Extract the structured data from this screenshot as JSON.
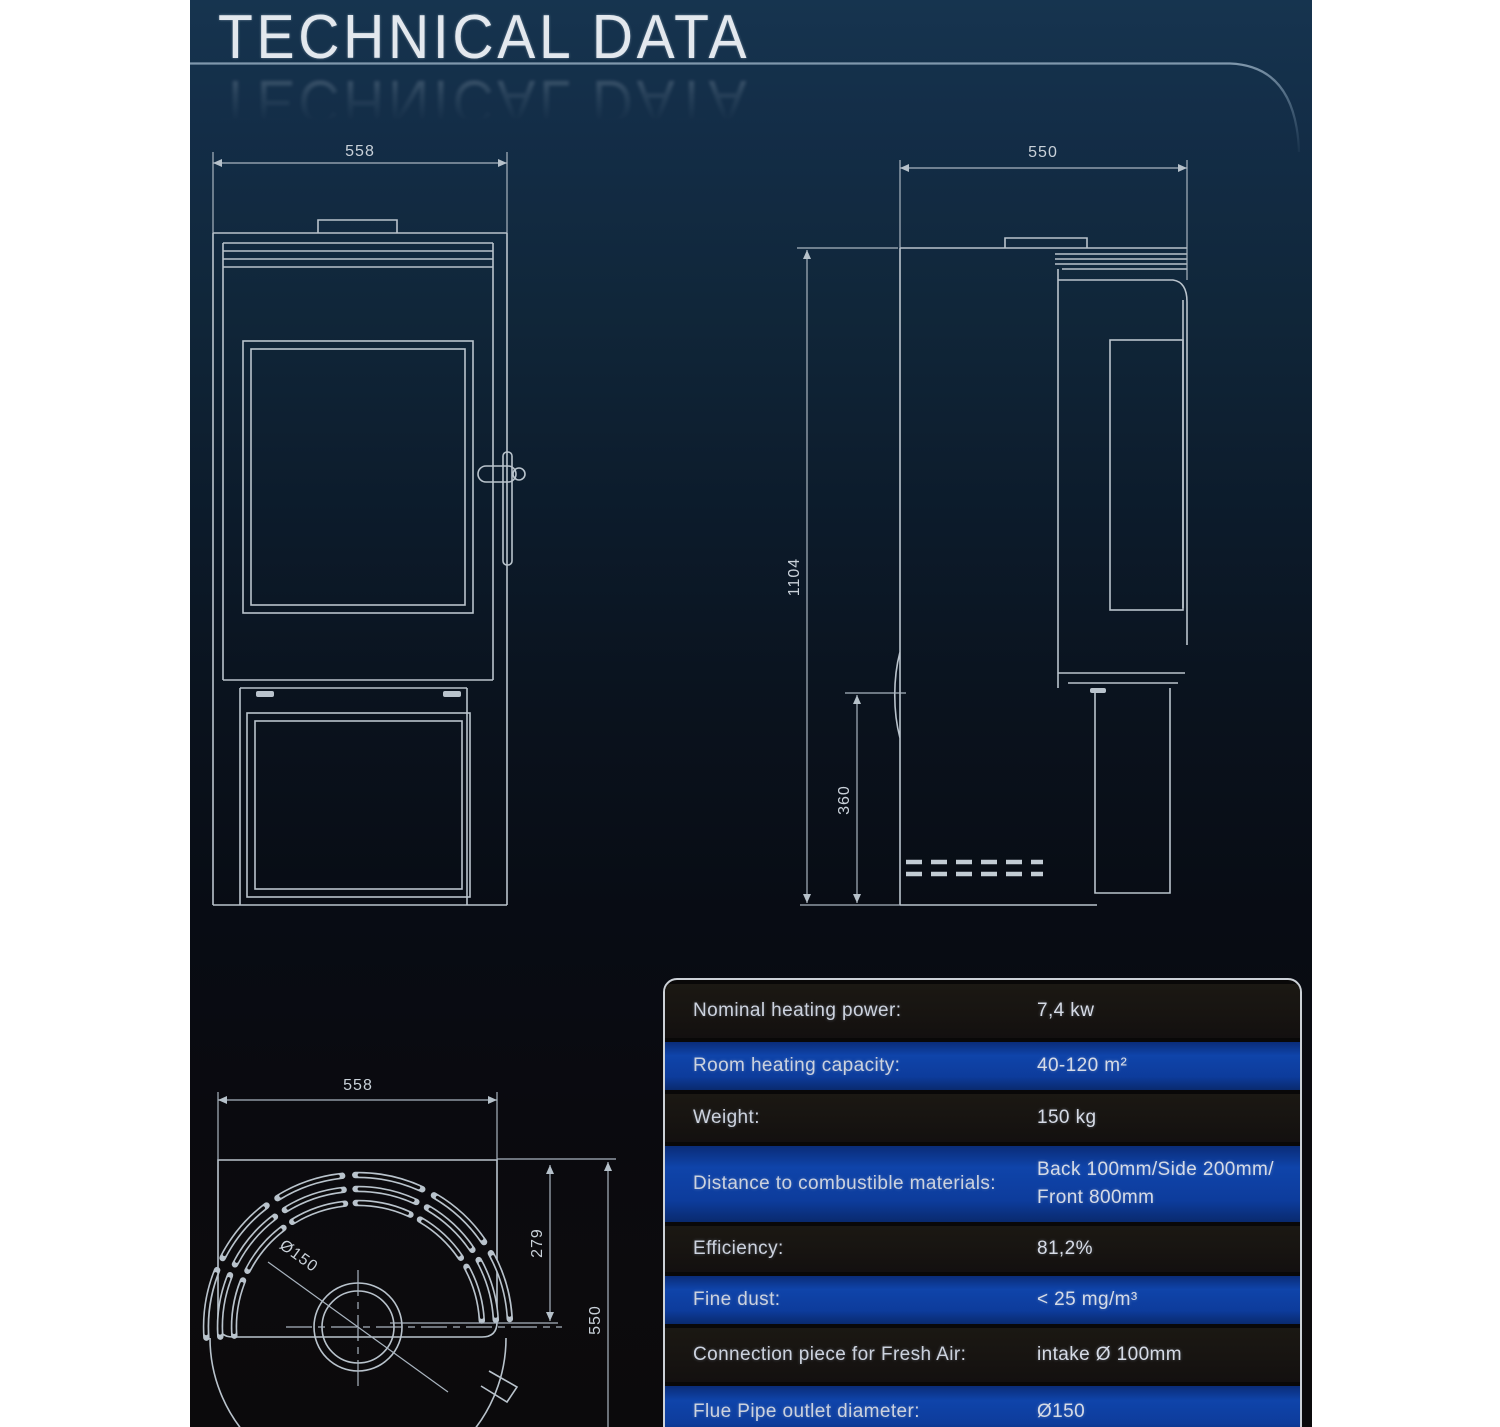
{
  "title": "TECHNICAL DATA",
  "drawings": {
    "front": {
      "width": "558"
    },
    "side": {
      "depth": "550",
      "height": "1104",
      "inlet_height": "360"
    },
    "top": {
      "width": "558",
      "flue_offset": "279",
      "depth": "550",
      "flue_diameter": "Ø150"
    }
  },
  "table": {
    "rows": [
      {
        "label": "Nominal heating power:",
        "value": "7,4 kw",
        "variant": "dark"
      },
      {
        "label": "Room heating capacity:",
        "value": "40-120 m²",
        "variant": "blue"
      },
      {
        "label": "Weight:",
        "value": "150 kg",
        "variant": "dark"
      },
      {
        "label": "Distance to combustible materials:",
        "value": "Back 100mm/Side 200mm/\nFront 800mm",
        "variant": "blue"
      },
      {
        "label": "Efficiency:",
        "value": "81,2%",
        "variant": "dark"
      },
      {
        "label": "Fine dust:",
        "value": "< 25 mg/m³",
        "variant": "blue"
      },
      {
        "label": "Connection piece for Fresh Air:",
        "value": "intake Ø 100mm",
        "variant": "dark"
      },
      {
        "label": "Flue Pipe outlet diameter:",
        "value": "Ø150",
        "variant": "blue"
      }
    ]
  }
}
